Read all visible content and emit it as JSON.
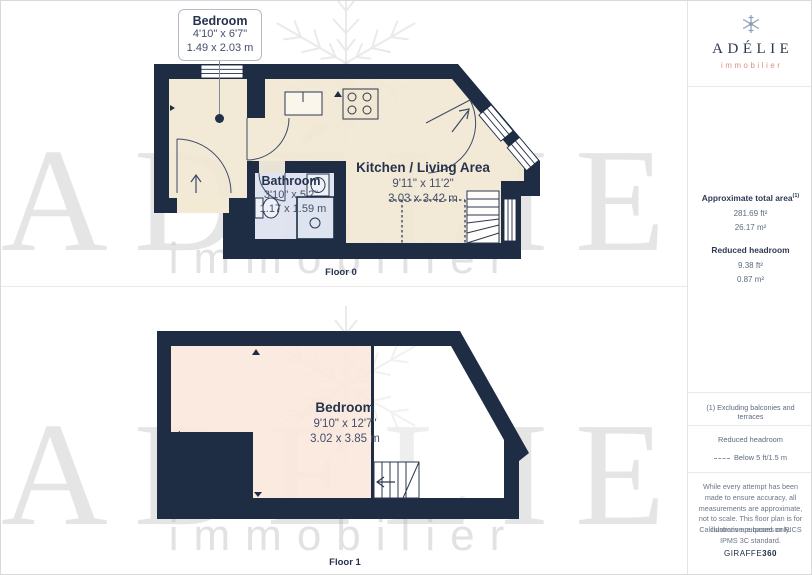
{
  "floor0": {
    "caption": "Floor 0",
    "callout": {
      "room": "Bedroom",
      "imperial": "4'10\" x 6'7\"",
      "metric": "1.49 x 2.03 m"
    },
    "bathroom": {
      "room": "Bathroom",
      "imperial": "3'10\" x 5'2\"",
      "metric": "1.17 x 1.59 m"
    },
    "kitchen": {
      "room": "Kitchen / Living Area",
      "imperial": "9'11\" x 11'2\"",
      "metric": "3.03 x 3.42 m"
    }
  },
  "floor1": {
    "caption": "Floor 1",
    "bedroom": {
      "room": "Bedroom",
      "imperial": "9'10\" x 12'7\"",
      "metric": "3.02 x 3.85 m"
    }
  },
  "watermark": {
    "name": "ADÉLIE",
    "tagline": "immobilier"
  },
  "sidebar": {
    "logo": {
      "name": "ADÉLIE",
      "tagline": "immobilier"
    },
    "area_summary": {
      "total_label": "Approximate total area",
      "total_sup": "(1)",
      "total_ft": "281.69 ft²",
      "total_m": "26.17 m²",
      "reduced_label": "Reduced headroom",
      "reduced_ft": "9.38 ft²",
      "reduced_m": "0.87 m²"
    },
    "footnote": "(1) Excluding balconies and terraces",
    "legend": {
      "title": "Reduced headroom",
      "item": "Below 5 ft/1.5 m"
    },
    "disclaimer": "While every attempt has been made to ensure accuracy, all measurements are approximate, not to scale. This floor plan is for illustrative purposes only.",
    "standard": "Calculations are based on RICS IPMS 3C standard.",
    "brand": {
      "name": "GIRAFFE",
      "suffix": "360"
    }
  },
  "colors": {
    "wall_navy": "#1f2d44",
    "floor_cream": "#f1e7d2",
    "floor_peach": "#f9e8dc",
    "bathroom_floor": "#dde3ef",
    "brand_salmon": "#d9907f",
    "logo_navy": "#2b3850",
    "snowflake_blue": "#8b9cb5"
  }
}
